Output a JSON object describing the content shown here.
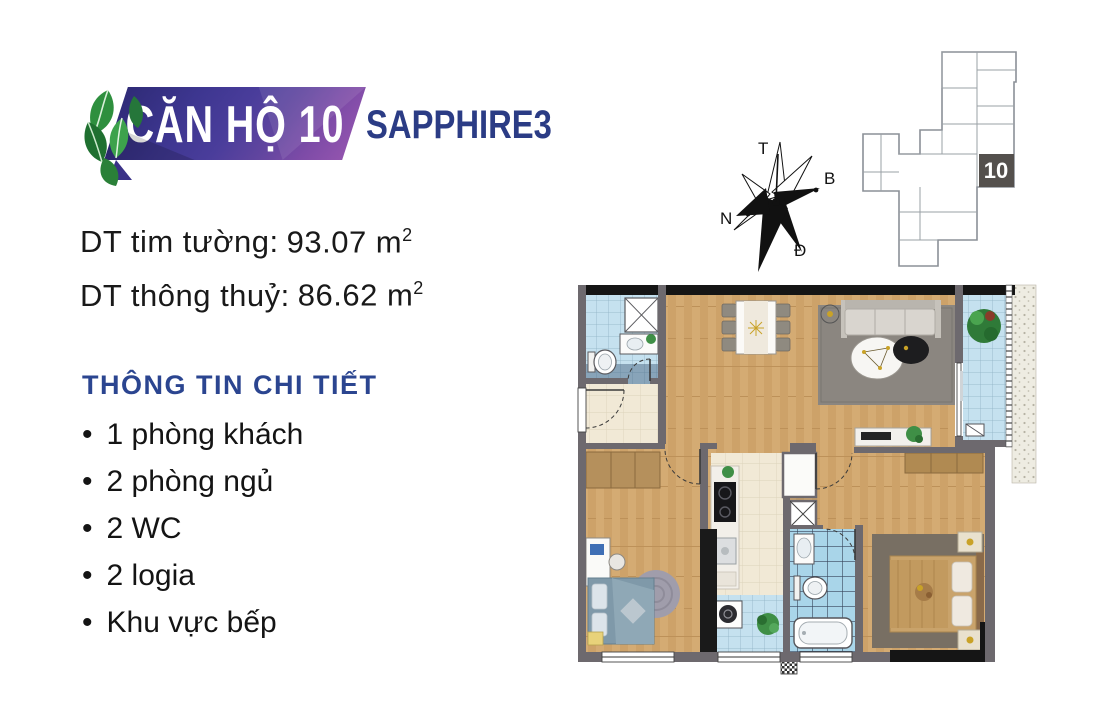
{
  "colors": {
    "badge_purple_dark": "#2f2b77",
    "badge_purple_light": "#9254ae",
    "brand_navy": "#2b3c85",
    "heading_blue": "#2b4590",
    "text_black": "#191919",
    "leaf_green": "#2e8f3e",
    "keyplan_highlight": "#54504d",
    "wall_gray": "#6d696e",
    "wc_tile_blue": "#c5e1ef",
    "wood_floor": "#d4ab73"
  },
  "header": {
    "unit_title": "CĂN HỘ 10",
    "project_name": "SAPPHIRE3"
  },
  "areas": [
    {
      "label": "DT tim tường:",
      "value": "93.07 m",
      "sup": "2"
    },
    {
      "label": "DT thông thuỷ:",
      "value": "86.62 m",
      "sup": "2"
    }
  ],
  "details": {
    "heading": "THÔNG TIN CHI TIẾT",
    "items": [
      "1 phòng khách",
      "2 phòng ngủ",
      "2 WC",
      "2 logia",
      "Khu vực bếp"
    ]
  },
  "compass": {
    "top": "T",
    "right": "B",
    "left": "N",
    "bottom": "Đ"
  },
  "key_plan": {
    "unit_number": "10"
  }
}
